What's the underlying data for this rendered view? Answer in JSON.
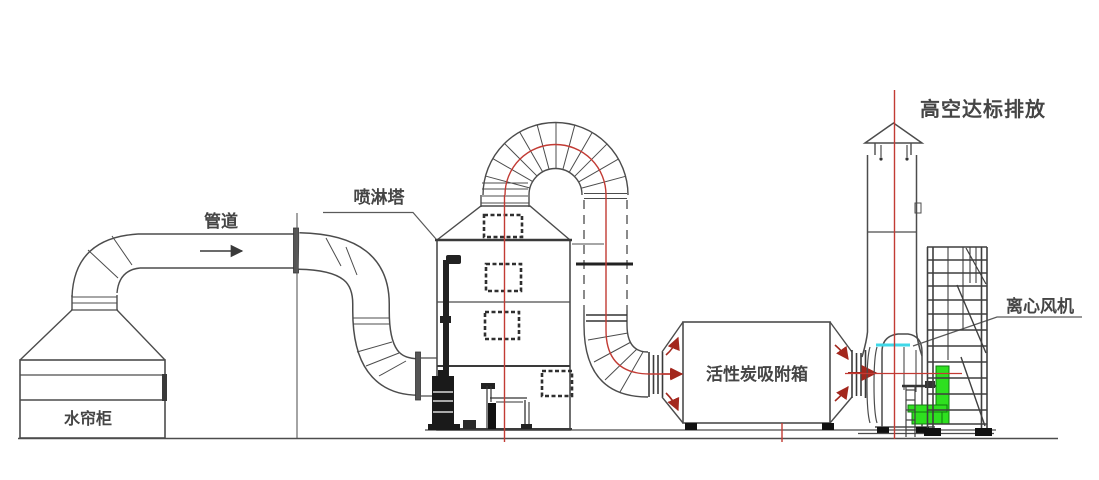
{
  "diagram": {
    "kind": "exhaust-gas-treatment-process-schematic",
    "labels": {
      "pipe": "管道",
      "spray_tower": "喷淋塔",
      "water_curtain_cabinet": "水帘柜",
      "activated_carbon_box": "活性炭吸附箱",
      "centrifugal_fan": "离心风机",
      "high_altitude_discharge": "高空达标排放"
    },
    "colors": {
      "line": "#4c4c4c",
      "dark_line": "#2b2b2b",
      "centerline_red": "#c23b34",
      "arrow_red": "#a3271d",
      "motor_green": "#2ee01f",
      "level_cyan": "#3fd8e8",
      "text": "#454545",
      "background": "#ffffff"
    }
  }
}
